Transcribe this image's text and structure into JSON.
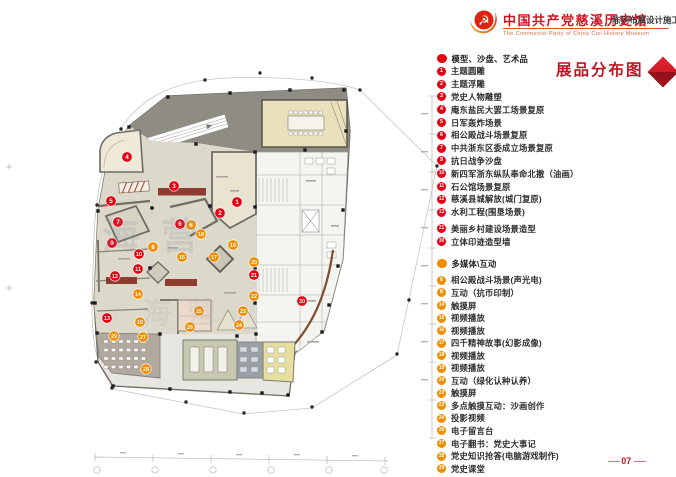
{
  "header": {
    "logo": "party-emblem-swoosh",
    "title_cn": "中国共产党慈溪历史馆",
    "title_en": "The Communist Party of China Cixi  History Museum",
    "subtitle": "陈列布展设计施工方案"
  },
  "sheet_title": "展品分布图",
  "page_number": "07",
  "page_number_display": "── 07 ──",
  "watermark": "海营",
  "colors": {
    "legend_red": "#e60012",
    "legend_orange": "#f18d00",
    "title_red": "#c01423",
    "banner_dark_red": "#8e3b31"
  },
  "legend": {
    "sections": [
      {
        "header": "模型、沙盘、艺术品",
        "color": "#e60012",
        "items": [
          {
            "num": "1",
            "label": "主题圆雕"
          },
          {
            "num": "2",
            "label": "主题浮雕"
          },
          {
            "num": "3",
            "label": "党史人物雕塑"
          },
          {
            "num": "4",
            "label": "庵东盐民大罢工场景复原"
          },
          {
            "num": "5",
            "label": "日军轰炸场景"
          },
          {
            "num": "6",
            "label": "相公殿战斗场景复原"
          },
          {
            "num": "7",
            "label": "中共浙东区委成立场景复原"
          },
          {
            "num": "9",
            "label": "抗日战争沙盘"
          },
          {
            "num": "10",
            "label": "新四军浙东纵队奉命北撤（油画）"
          },
          {
            "num": "11",
            "label": "石公馆场景复原"
          },
          {
            "num": "12",
            "label": "慈溪县城解放(城门复原)"
          },
          {
            "num": "13",
            "label": "水利工程(围垦场景)"
          },
          {
            "num": "21",
            "label": "美丽乡村建设场景造型",
            "gap": "sm"
          },
          {
            "num": "30",
            "label": "立体印迹造型墙"
          }
        ]
      },
      {
        "header": "多媒体\\互动",
        "color": "#f18d00",
        "items": [
          {
            "num": "6",
            "label": "相公殿战斗场景(声光电)",
            "gap": "sm"
          },
          {
            "num": "8",
            "label": "互动（抗币印制）"
          },
          {
            "num": "14",
            "label": "触摸屏"
          },
          {
            "num": "15",
            "label": "视频播放"
          },
          {
            "num": "16",
            "label": "视频播放"
          },
          {
            "num": "17",
            "label": "四千精神故事(幻影成像)"
          },
          {
            "num": "18",
            "label": "视频播放"
          },
          {
            "num": "19",
            "label": "视频播放"
          },
          {
            "num": "20",
            "label": "互动（绿化认种认养）"
          },
          {
            "num": "22",
            "label": "触摸屏"
          },
          {
            "num": "23",
            "label": "多点触摸互动：沙画创作"
          },
          {
            "num": "24",
            "label": "投影视频"
          },
          {
            "num": "26",
            "label": "电子留言台"
          },
          {
            "num": "27",
            "label": "电子翻书：党史大事记"
          },
          {
            "num": "28",
            "label": "党史知识抢答(电脑游戏制作)"
          },
          {
            "num": "29",
            "label": "党史课堂"
          }
        ]
      }
    ]
  },
  "plan": {
    "markers": [
      {
        "num": "1",
        "type": "red",
        "x": 237,
        "y": 202
      },
      {
        "num": "2",
        "type": "red",
        "x": 220,
        "y": 213
      },
      {
        "num": "3",
        "type": "red",
        "x": 174,
        "y": 186
      },
      {
        "num": "4",
        "type": "red",
        "x": 127,
        "y": 157
      },
      {
        "num": "5",
        "type": "red",
        "x": 111,
        "y": 201
      },
      {
        "num": "6",
        "type": "red",
        "x": 180,
        "y": 224
      },
      {
        "num": "6",
        "type": "orange",
        "x": 191,
        "y": 225
      },
      {
        "num": "7",
        "type": "red",
        "x": 118,
        "y": 222
      },
      {
        "num": "8",
        "type": "orange",
        "x": 153,
        "y": 247
      },
      {
        "num": "9",
        "type": "red",
        "x": 112,
        "y": 243
      },
      {
        "num": "10",
        "type": "red",
        "x": 139,
        "y": 254
      },
      {
        "num": "11",
        "type": "red",
        "x": 138,
        "y": 269
      },
      {
        "num": "12",
        "type": "red",
        "x": 115,
        "y": 276
      },
      {
        "num": "13",
        "type": "red",
        "x": 107,
        "y": 318
      },
      {
        "num": "14",
        "type": "orange",
        "x": 138,
        "y": 294
      },
      {
        "num": "15",
        "type": "orange",
        "x": 140,
        "y": 322
      },
      {
        "num": "16",
        "type": "orange",
        "x": 182,
        "y": 257
      },
      {
        "num": "17",
        "type": "orange",
        "x": 214,
        "y": 257
      },
      {
        "num": "18",
        "type": "orange",
        "x": 201,
        "y": 234
      },
      {
        "num": "19",
        "type": "orange",
        "x": 233,
        "y": 245
      },
      {
        "num": "20",
        "type": "orange",
        "x": 254,
        "y": 262
      },
      {
        "num": "21",
        "type": "red",
        "x": 254,
        "y": 275
      },
      {
        "num": "22",
        "type": "orange",
        "x": 254,
        "y": 296
      },
      {
        "num": "23",
        "type": "orange",
        "x": 243,
        "y": 311
      },
      {
        "num": "24",
        "type": "orange",
        "x": 239,
        "y": 325
      },
      {
        "num": "25",
        "type": "orange",
        "x": 199,
        "y": 311
      },
      {
        "num": "26",
        "type": "orange",
        "x": 190,
        "y": 327
      },
      {
        "num": "27",
        "type": "orange",
        "x": 143,
        "y": 337
      },
      {
        "num": "28",
        "type": "orange",
        "x": 146,
        "y": 369
      },
      {
        "num": "29",
        "type": "orange",
        "x": 114,
        "y": 336
      },
      {
        "num": "30",
        "type": "red",
        "x": 302,
        "y": 301
      }
    ]
  }
}
